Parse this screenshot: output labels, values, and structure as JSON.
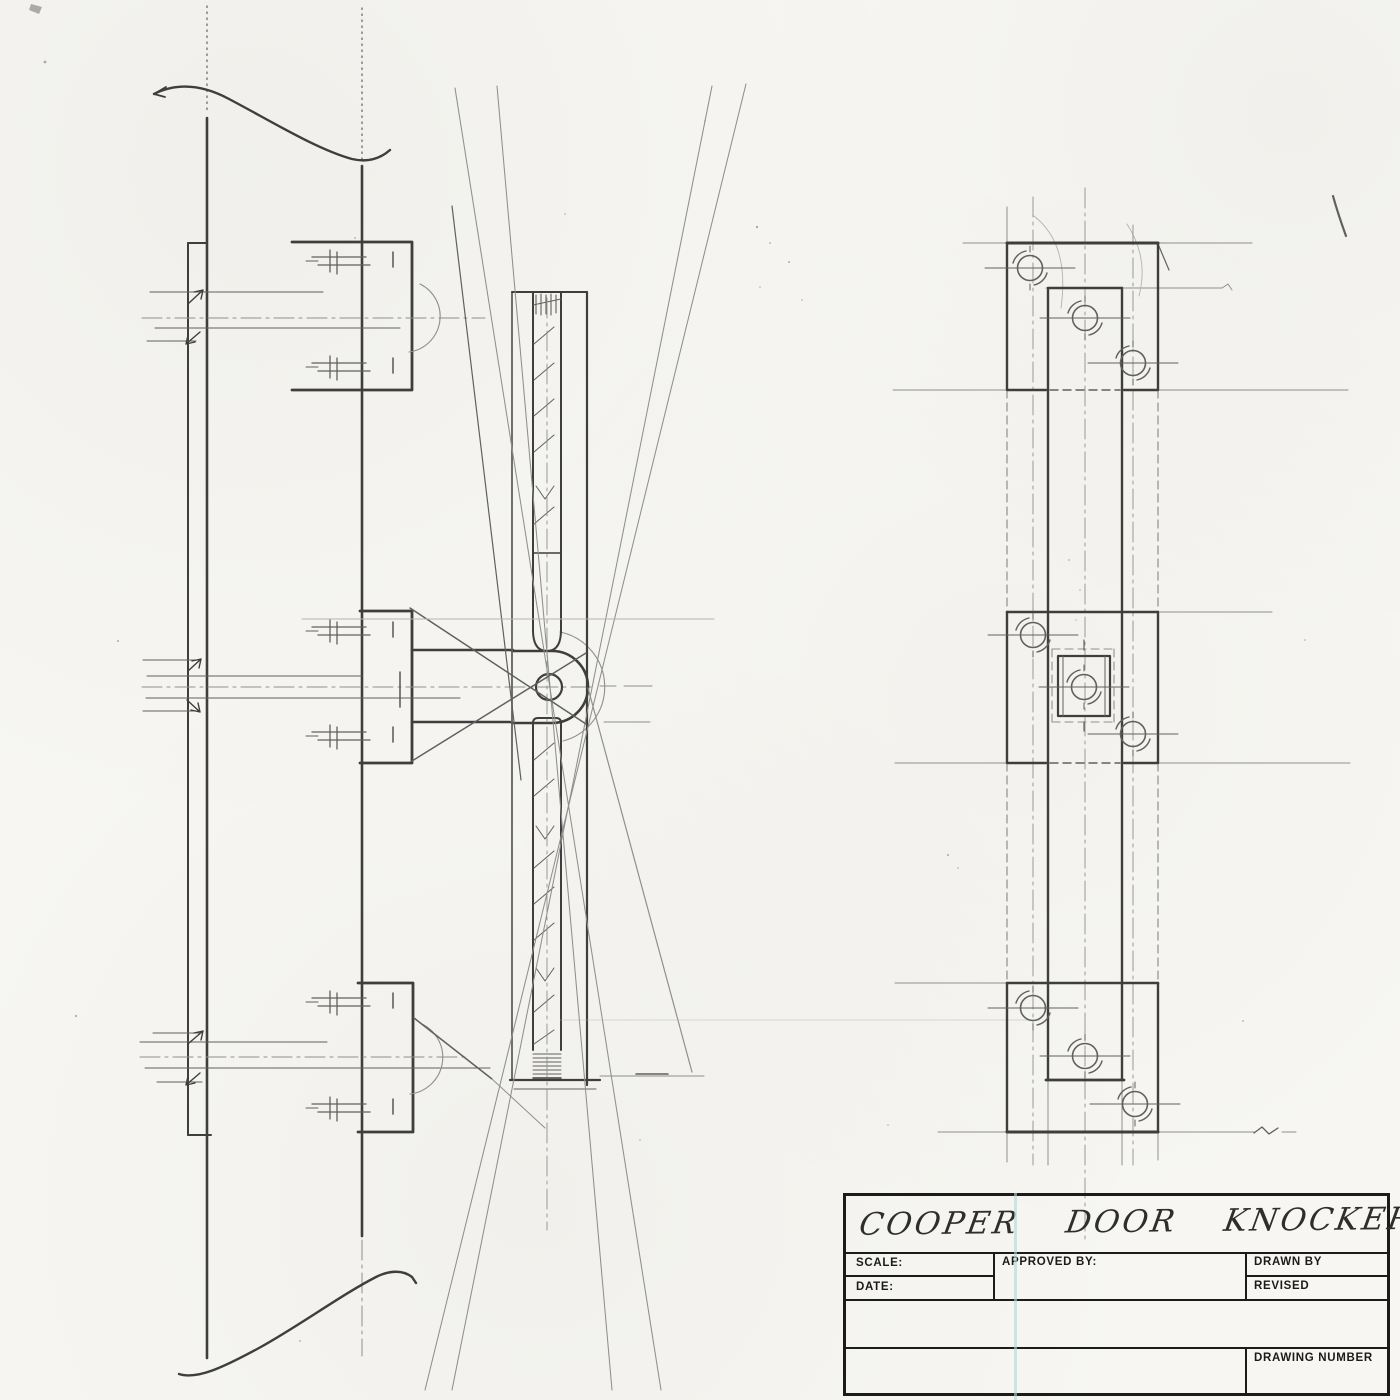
{
  "title_block": {
    "title": "COOPER DOOR KNOCKER",
    "scale_label": "SCALE:",
    "date_label": "DATE:",
    "approved_by_label": "APPROVED BY:",
    "drawn_by_label": "DRAWN BY",
    "revised_label": "REVISED",
    "drawing_number_label": "DRAWING NUMBER"
  },
  "colors": {
    "paper": "#f7f6f2",
    "pencil_dark": "#3e3e3e",
    "pencil_medium": "#606060",
    "construction": "#8f8f8f",
    "construction_light": "#b3b3b3",
    "titleblock_ink": "#1b1b1b",
    "scan_line": "#b7d6d3",
    "handwriting": "#2e2e2e"
  }
}
